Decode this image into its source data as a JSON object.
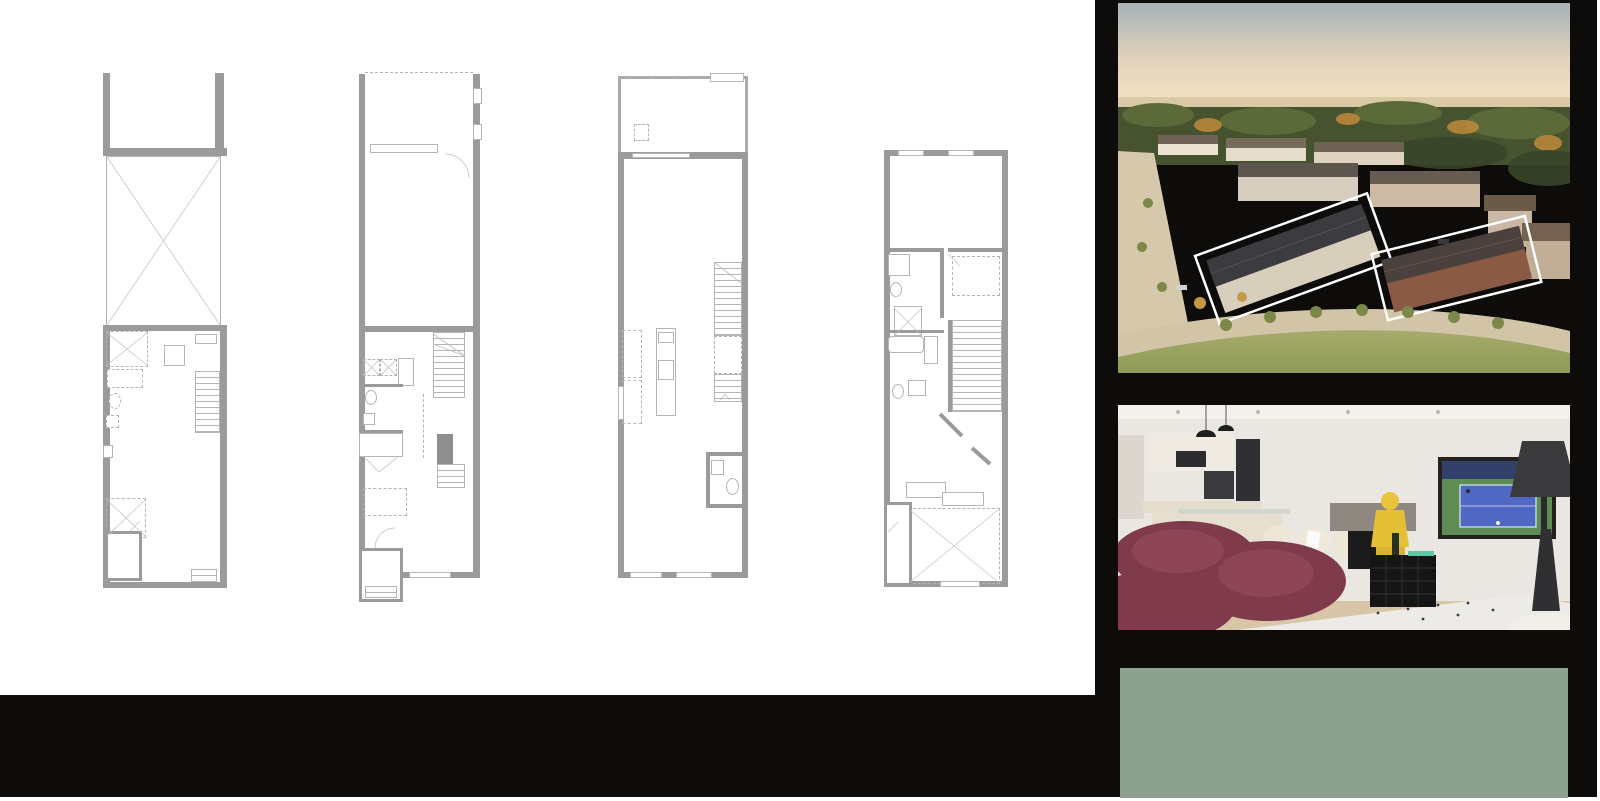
{
  "floor_titles": [
    {
      "line1": "BASEMENT",
      "line2": "ELEVATION A / B"
    },
    {
      "line1": "FIRST FLOOR",
      "line2": "ELEVATION A / B"
    },
    {
      "line1": "SECOND FLOOR",
      "line2": "ELEVATION A / B"
    },
    {
      "line1": "THIRD FLOOR",
      "line2": "ELEVATION A"
    }
  ],
  "plans": {
    "basement": {
      "labels": [
        {
          "t": "UNEXCAVATED",
          "x": 61,
          "y": 162,
          "c": "m ctr"
        },
        {
          "t": "TWH",
          "x": 102,
          "y": 263,
          "c": "xxs ctr"
        },
        {
          "t": "FURN.",
          "x": 72,
          "y": 277,
          "c": "xxs ctr"
        },
        {
          "t": "LOW HEADROOM\n(IF REQ'D BY\nGRADE)",
          "x": 6,
          "y": 276,
          "c": "xxs"
        },
        {
          "t": "UP",
          "x": 101,
          "y": 310,
          "c": "xxs"
        },
        {
          "t": "↓",
          "x": 103,
          "y": 320,
          "c": "xs"
        },
        {
          "t": "3PC.\nROUGH-IN",
          "x": 36,
          "y": 370,
          "c": "xxs ctr"
        },
        {
          "t": "LOW HEADROOM\n(IF REQ'D BY\nGRADE)",
          "x": 9,
          "y": 440,
          "c": "xxs"
        },
        {
          "t": "UNFINISHED\nBASEMENT",
          "x": 83,
          "y": 464,
          "c": "m ctr"
        },
        {
          "t": "UNEX.\nCOLD ROOM\n(WHERE GRADE\nPERMITS)",
          "x": 23,
          "y": 478,
          "c": "xxs ctr"
        }
      ]
    },
    "first": {
      "labels": [
        {
          "t": "GARAGE",
          "x": 38,
          "y": 89,
          "c": "m ctr"
        },
        {
          "t": "13'11\" x 20'5\"",
          "x": 38,
          "y": 100,
          "c": "d ctr"
        },
        {
          "t": "STEPS AS\nREQUIRED\nBY GRADE",
          "x": 8,
          "y": 228,
          "c": "xxs"
        },
        {
          "t": "DOOR WHERE\nGRADE PERMITS",
          "x": 36,
          "y": 243,
          "c": "xxs"
        },
        {
          "t": "LAUNDRY",
          "x": 5,
          "y": 281,
          "c": "xxs"
        },
        {
          "t": "W",
          "x": 9,
          "y": 292,
          "c": "xxs"
        },
        {
          "t": "D",
          "x": 26,
          "y": 292,
          "c": "xxs"
        },
        {
          "t": "LINEN",
          "x": 50,
          "y": 290,
          "c": "xxs rot",
          "r": 90
        },
        {
          "t": "UP",
          "x": 77,
          "y": 264,
          "c": "xxs"
        },
        {
          "t": "↓",
          "x": 78,
          "y": 272,
          "c": "xs"
        },
        {
          "t": "PWD",
          "x": 29,
          "y": 334,
          "c": "s ctr"
        },
        {
          "t": "OPT.\nWALL &\nDOOR",
          "x": 66,
          "y": 332,
          "c": "xxs"
        },
        {
          "t": "CLOSET",
          "x": 22,
          "y": 365,
          "c": "xxs ctr bx"
        },
        {
          "t": "DN",
          "x": 75,
          "y": 398,
          "c": "xxs"
        },
        {
          "t": "STEPS AS\nREQUIRED\nBY GRADE",
          "x": 9,
          "y": 401,
          "c": "xxs"
        },
        {
          "t": "FOYER",
          "x": 27,
          "y": 440,
          "c": "m ctr"
        },
        {
          "t": "PORCH",
          "x": 21,
          "y": 479,
          "c": "xs ctr"
        },
        {
          "t": "STEPS AS\nREQUIRED\nBY GRADE",
          "x": 10,
          "y": 489,
          "c": "xxs"
        },
        {
          "t": "DEN",
          "x": 92,
          "y": 480,
          "c": "m ctr"
        },
        {
          "t": "9'0\" x 9'11\"",
          "x": 92,
          "y": 491,
          "c": "d ctr"
        }
      ]
    },
    "second": {
      "labels": [
        {
          "t": "GLASS GUARD",
          "x": 9,
          "y": 1,
          "c": "xxs"
        },
        {
          "t": "LOW WALL",
          "x": 108,
          "y": 2,
          "c": "xxs ctr"
        },
        {
          "t": "BALCONY",
          "x": 64,
          "y": 19,
          "c": "m ctr"
        },
        {
          "t": "PRIVACY SCREEN",
          "x": 9,
          "y": 24,
          "c": "xxs rot",
          "r": 90
        },
        {
          "t": "PRIVACY SCREEN",
          "x": 129,
          "y": 24,
          "c": "xxs rot",
          "r": 90
        },
        {
          "t": "FUTURE\nA/C\nLOCATION",
          "x": 34,
          "y": 55,
          "c": "xxs"
        },
        {
          "t": "SLIDING DOOR",
          "x": 71,
          "y": 91,
          "c": "xxs"
        },
        {
          "t": "FAMILY ROOM",
          "x": 58,
          "y": 106,
          "c": "m ctr"
        },
        {
          "t": "13'11\" x 11'8\"",
          "x": 58,
          "y": 117,
          "c": "d ctr"
        },
        {
          "t": "BREAKFAST",
          "x": 52,
          "y": 204,
          "c": "m ctr"
        },
        {
          "t": "10'6\" x 9'0\"",
          "x": 52,
          "y": 215,
          "c": "d ctr"
        },
        {
          "t": "UP",
          "x": 104,
          "y": 196,
          "c": "xxs"
        },
        {
          "t": "↓",
          "x": 105,
          "y": 204,
          "c": "xs"
        },
        {
          "t": "DW",
          "x": 43,
          "y": 264,
          "c": "xxs"
        },
        {
          "t": "KITCHEN",
          "x": 60,
          "y": 347,
          "c": "xs ctr"
        },
        {
          "t": "10'6\"(7'6\") x 11'0\"",
          "x": 60,
          "y": 356,
          "c": "xxs ctr"
        },
        {
          "t": "DN",
          "x": 86,
          "y": 362,
          "c": "xxs"
        },
        {
          "t": "PWD",
          "x": 112,
          "y": 399,
          "c": "s ctr"
        },
        {
          "t": "LIVING / DINING",
          "x": 64,
          "y": 486,
          "c": "m ctr"
        },
        {
          "t": "13'11\" (9'3\") x 18'0\" (9'11\")",
          "x": 64,
          "y": 497,
          "c": "d ctr"
        }
      ]
    },
    "third": {
      "labels": [
        {
          "t": "PRIMARY BEDROOM",
          "x": 62,
          "y": 40,
          "c": "m ctr"
        },
        {
          "t": "13'11\" x 10'8\"",
          "x": 62,
          "y": 51,
          "c": "d ctr"
        },
        {
          "t": "ENSUITE",
          "x": 33,
          "y": 127,
          "c": "xs ctr"
        },
        {
          "t": "WALK-IN\nCLOSET",
          "x": 92,
          "y": 120,
          "c": "xxs ctr"
        },
        {
          "t": "LEDGE",
          "x": 8,
          "y": 157,
          "c": "xxs rot",
          "r": 90
        },
        {
          "t": "MAIN\nBATH",
          "x": 16,
          "y": 205,
          "c": "xs"
        },
        {
          "t": "LINEN",
          "x": 48,
          "y": 186,
          "c": "xxs rot",
          "r": 90
        },
        {
          "t": "DN",
          "x": 100,
          "y": 236,
          "c": "xxs"
        },
        {
          "t": "BEDROOM 3",
          "x": 33,
          "y": 251,
          "c": "m ctr"
        },
        {
          "t": "10'0\" x 10'0\"",
          "x": 33,
          "y": 262,
          "c": "d ctr"
        },
        {
          "t": "UP",
          "x": 12,
          "y": 343,
          "c": "xxs"
        },
        {
          "t": "↓",
          "x": 13,
          "y": 351,
          "c": "xs"
        },
        {
          "t": "CLOSET",
          "x": 42,
          "y": 336,
          "c": "xxs ctr bx"
        },
        {
          "t": "CLOSET",
          "x": 78,
          "y": 347,
          "c": "xxs ctr bx"
        },
        {
          "t": "RAISED CEILING",
          "x": 72,
          "y": 362,
          "c": "xxs ctr"
        },
        {
          "t": "GARDEN\nDOOR",
          "x": 4,
          "y": 385,
          "c": "xxs bx"
        },
        {
          "t": "BALCONY",
          "x": 4,
          "y": 409,
          "c": "xxs"
        },
        {
          "t": "BEDROOM 2",
          "x": 77,
          "y": 416,
          "c": "m ctr"
        },
        {
          "t": "10'0\" x 9'6\"",
          "x": 77,
          "y": 427,
          "c": "d ctr"
        }
      ]
    }
  },
  "right_panel": {
    "interior_caption": "C-1944 Family Room, Breakfast, and Kitchen",
    "neon_sign": "Bonjour Bubbly",
    "unit": {
      "collection": "CITY TOWN",
      "code": "C-1944",
      "area": "1,944 SQ.FT."
    }
  },
  "footer": {
    "brand_top": "MADISON",
    "brand_bottom": "GROUP",
    "disclaimer": "Dimensions, materials, specifications, structural elements and floorplans are subject to change without notice. Actual usable floor space may vary from the stated floor area. Layout shown may be the reverse of the unit purchased. Exterior elevation and site plan are subject to approval by applicable authorities and the purchaser agrees to accept any change. The size and location of window, mullions, exterior doors, furnaces, HVAC Units, patios and/or balconies are subject to change and may vary depending on unit location within the project. All illustrations are artist`s concept only. E. & O. E., June 2023"
  }
}
